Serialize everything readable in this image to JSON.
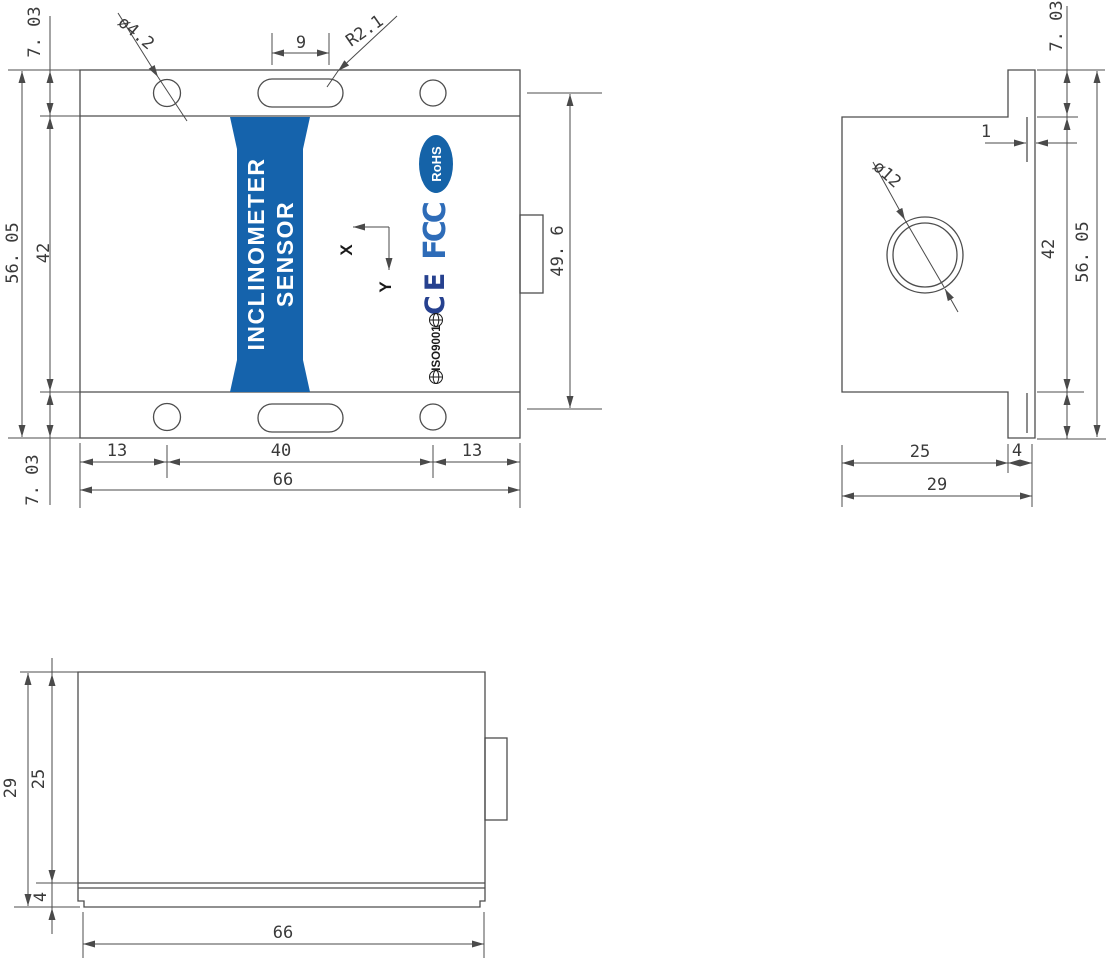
{
  "front_view": {
    "banner": {
      "line1": "INCLINOMETER",
      "line2": "SENSOR",
      "color": "#1563ac"
    },
    "axes": {
      "x_label": "X",
      "y_label": "Y"
    },
    "logos": {
      "rohs": "RoHS",
      "rohs_color": "#1563a8",
      "fcc": "FCC",
      "fcc_color": "#2e6cb8",
      "ce": "CE",
      "ce_color": "#26418f",
      "iso": "ISO9001"
    },
    "dims": {
      "top_flange_height": "7. 03",
      "overall_height": "56. 05",
      "inner_height": "42",
      "bottom_flange_height": "7. 03",
      "mount_hole_diameter": "ø4.2",
      "slot_length": "9",
      "slot_end_radius": "R2.1",
      "hole_row_spacing": "49. 6",
      "left_hole_offset": "13",
      "hole_spacing": "40",
      "right_hole_offset": "13",
      "overall_width": "66"
    }
  },
  "side_view": {
    "dims": {
      "top_flange_height": "7. 03",
      "step_width": "1",
      "inner_height": "42",
      "overall_height": "56. 05",
      "bore_diameter": "ø12",
      "body_depth": "25",
      "flange_thickness": "4",
      "overall_depth": "29"
    }
  },
  "bottom_view": {
    "dims": {
      "overall_depth": "29",
      "body_depth": "25",
      "base_thickness": "4",
      "overall_width": "66"
    }
  }
}
